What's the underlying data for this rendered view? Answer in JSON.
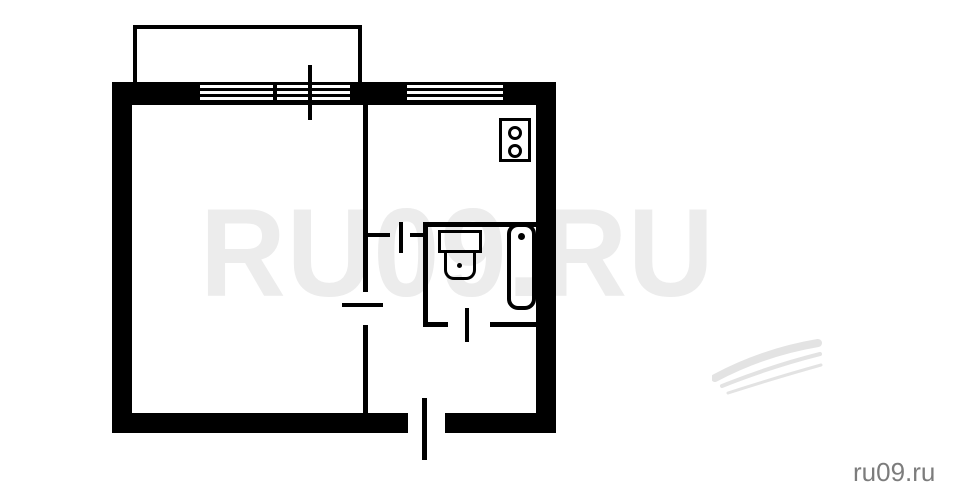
{
  "page": {
    "title": "apartment floor plan",
    "background": "#ffffff",
    "width": 959,
    "height": 501
  },
  "watermark": {
    "center_text": "RU09.RU",
    "center_color": "#ececec",
    "corner_text": "ru09.ru",
    "corner_color": "#7c7c7c",
    "swoosh_color": "#e3e3e3"
  },
  "floorplan": {
    "wall_color": "#000000",
    "symbols": {
      "balcony": "balcony",
      "windows": [
        "living-room-window",
        "kitchen-window"
      ],
      "doors": [
        "balcony-door-tick",
        "living-room-door",
        "kitchen-door",
        "bathroom-door",
        "entrance-door"
      ],
      "fixtures": [
        "stove",
        "toilet",
        "bathtub"
      ]
    }
  }
}
